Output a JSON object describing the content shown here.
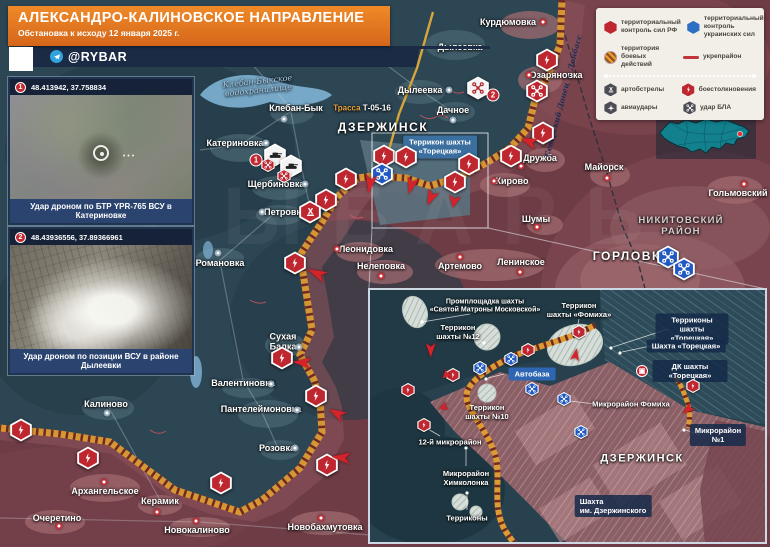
{
  "header": {
    "title": "АЛЕКСАНДРО-КАЛИНОВСКОЕ НАПРАВЛЕНИЕ",
    "subtitle": "Обстановка к исходу 12 января 2025 г.",
    "brand": "@RYBAR"
  },
  "legend": {
    "items": [
      {
        "icon": "hex-red",
        "label": "территориальный\nконтроль сил РФ"
      },
      {
        "icon": "hex-blue",
        "label": "территориальный\nконтроль украинских сил"
      },
      {
        "icon": "circle-striped",
        "label": "территория\nбоевых действий"
      },
      {
        "icon": "red-line",
        "label": "укрепрайон"
      },
      {
        "icon": "hex-artillery",
        "label": "артобстрелы"
      },
      {
        "icon": "hex-clash",
        "label": "боестолкновения"
      },
      {
        "icon": "hex-airstrike",
        "label": "авиаудары"
      },
      {
        "icon": "hex-drone",
        "label": "удар БЛА"
      }
    ]
  },
  "photos": [
    {
      "marker": "1",
      "coords": "48.413942, 37.758834",
      "caption": "Удар дроном по БТР YPR-765 ВСУ в Катериновке"
    },
    {
      "marker": "2",
      "coords": "48.43936556, 37.89366961",
      "caption": "Удар дроном по позиции ВСУ в районе Дылеевки"
    }
  ],
  "map": {
    "labels": {
      "kurdyumovka": {
        "text": "Курдюмовка"
      },
      "dyleevka_n": {
        "text": "Дылеевка"
      },
      "ozaryanovka": {
        "text": "Озаряновка"
      },
      "dyleevka_w": {
        "text": "Дылеевка"
      },
      "dachnoe": {
        "text": "Дачное"
      },
      "reservoir": {
        "text": "Клебан-Быкское\nводохранилище"
      },
      "kleban_byk": {
        "text": "Клебан-Бык"
      },
      "road_prefix": {
        "text": "Трасса"
      },
      "road_number": {
        "text": "Т-05-16"
      },
      "katerinovka": {
        "text": "Катериновка"
      },
      "shcherbinovka": {
        "text": "Щербиновка"
      },
      "petrovka": {
        "text": "Петровка"
      },
      "dzerzhinsk": {
        "text": "ДЗЕРЖИНСК"
      },
      "terrikon_box": {
        "text": "Террикон шахты\n«Торецкая»"
      },
      "kirovo": {
        "text": "Кирово"
      },
      "druzhba": {
        "text": "Дружба"
      },
      "shumy": {
        "text": "Шумы"
      },
      "mayorsk": {
        "text": "Майорск"
      },
      "golmovsky": {
        "text": "Гольмовский"
      },
      "nikitovsky": {
        "text": "НИКИТОВСКИЙ\nРАЙОН"
      },
      "gorlovka": {
        "text": "ГОРЛОВКА"
      },
      "leonidovka": {
        "text": "Леонидовка"
      },
      "nelepovka": {
        "text": "Нелеповка"
      },
      "artemovo": {
        "text": "Артемово"
      },
      "leninskoe": {
        "text": "Ленинское"
      },
      "romanovka": {
        "text": "Романовка"
      },
      "sukhaya_balka": {
        "text": "Сухая\nБалка"
      },
      "valentinovka": {
        "text": "Валентиновка"
      },
      "panteleymonovka": {
        "text": "Пантелеймоновка"
      },
      "kalinovo": {
        "text": "Калиново"
      },
      "rozovka": {
        "text": "Розовка"
      },
      "arkhangelskoe": {
        "text": "Архангельское"
      },
      "keramik": {
        "text": "Керамик"
      },
      "ocheretino": {
        "text": "Очеретино"
      },
      "novokalinovo": {
        "text": "Новокалиново"
      },
      "novobakhmutovka": {
        "text": "Новобахмутовка"
      },
      "canal": {
        "text": "Северский Донец — Донбасс"
      }
    }
  },
  "inset": {
    "labels": {
      "promploshchadka": {
        "text": "Промплощадка шахты\n«Святой Матроны Московской»"
      },
      "terrikon12": {
        "text": "Террикон\nшахты №12"
      },
      "terrikon_fomikha": {
        "text": "Террикон\nшахты «Фомиха»"
      },
      "terrikony_toretskaya": {
        "text": "Терриконы шахты «Торецкая»"
      },
      "shakhta_toretskaya": {
        "text": "Шахта «Торецкая»"
      },
      "dk_toretskaya": {
        "text": "ДК шахты «Торецкая»"
      },
      "avtobaza": {
        "text": "Автобаза"
      },
      "terrikon10": {
        "text": "Террикон\nшахты №10"
      },
      "mikrorayon_fomikha": {
        "text": "Микрорайон Фомиха"
      },
      "mikrorayon12": {
        "text": "12-й микрорайон"
      },
      "khimkolonka": {
        "text": "Микрорайон\nХимколонка"
      },
      "terrikony": {
        "text": "Терриконы"
      },
      "mikrorayon1": {
        "text": "Микрорайон №1"
      },
      "dzerzhinsk": {
        "text": "ДЗЕРЖИНСК"
      },
      "shakhta_dzerzhinskogo": {
        "text": "Шахта\nим. Дзержинского"
      }
    }
  },
  "watermark": "РЫБАРЬ",
  "colors": {
    "rf_control": "#6e3c45",
    "ua_control": "#2d4654",
    "combat_band": "#dd9b33",
    "accent_orange": "#ef8325",
    "navy": "#1b2b45",
    "clash_red": "#bf2730",
    "uav_blue": "#2159c4"
  }
}
